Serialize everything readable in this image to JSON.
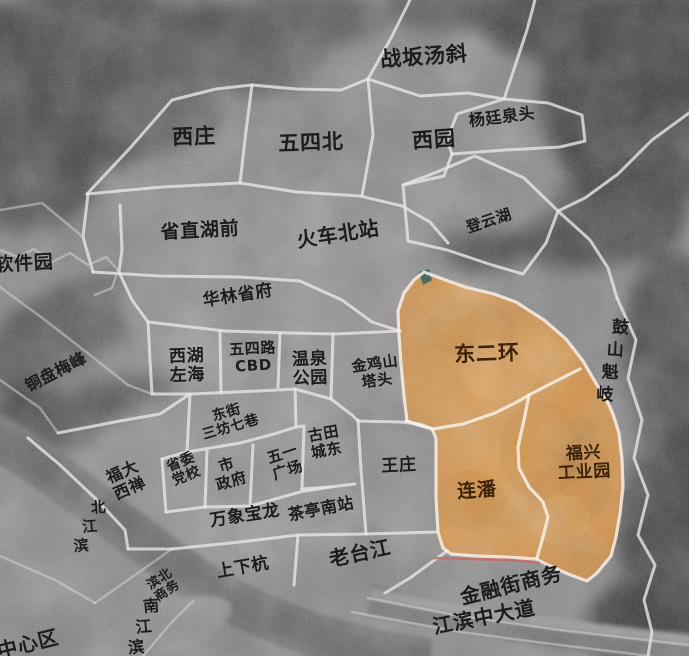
{
  "map": {
    "type": "satellite-district-map",
    "highlighted_regions": [
      "东二环",
      "连潘",
      "福兴工业园"
    ],
    "colors": {
      "highlight_fill": "#d68e3c",
      "boundary_line": "#e6e6e6",
      "label_text": "#1c1c1c",
      "highlight_label_text": "#3a2306",
      "red_road": "#cc6666"
    },
    "labels": [
      {
        "name": "zhanban-tangxie",
        "lines": [
          "战坂汤斜"
        ],
        "x": 424,
        "y": 57,
        "rot": -4,
        "size": 21
      },
      {
        "name": "yangting-quantou",
        "lines": [
          "杨廷泉头"
        ],
        "x": 502,
        "y": 117,
        "rot": -7,
        "size": 16
      },
      {
        "name": "xizhuang",
        "lines": [
          "西庄"
        ],
        "x": 194,
        "y": 137,
        "rot": -2,
        "size": 21
      },
      {
        "name": "wusibei",
        "lines": [
          "五四北"
        ],
        "x": 311,
        "y": 143,
        "rot": -2,
        "size": 21
      },
      {
        "name": "xiyuan",
        "lines": [
          "西园"
        ],
        "x": 434,
        "y": 140,
        "rot": -4,
        "size": 21
      },
      {
        "name": "dengyunhu",
        "lines": [
          "登云湖"
        ],
        "x": 489,
        "y": 221,
        "rot": -18,
        "size": 15
      },
      {
        "name": "shengzhi-huqian",
        "lines": [
          "省直湖前"
        ],
        "x": 200,
        "y": 231,
        "rot": -3,
        "size": 19
      },
      {
        "name": "huoche-beizhan",
        "lines": [
          "火车北站"
        ],
        "x": 338,
        "y": 234,
        "rot": -9,
        "size": 20
      },
      {
        "name": "ruanjianyuan",
        "lines": [
          "软件园"
        ],
        "x": 24,
        "y": 264,
        "rot": -3,
        "size": 19
      },
      {
        "name": "hualin-shengfu",
        "lines": [
          "华林省府"
        ],
        "x": 238,
        "y": 296,
        "rot": -9,
        "size": 17
      },
      {
        "name": "tongpan-meifeng",
        "lines": [
          "铜盘梅峰"
        ],
        "x": 56,
        "y": 372,
        "rot": -27,
        "size": 16
      },
      {
        "name": "xihu-zuohai",
        "lines": [
          "西湖",
          "左海"
        ],
        "x": 187,
        "y": 366,
        "rot": -2,
        "size": 17
      },
      {
        "name": "wusilu-cbd",
        "lines": [
          "五四路",
          "CBD"
        ],
        "x": 253,
        "y": 357,
        "rot": -3,
        "size": 15
      },
      {
        "name": "wenquan-gongyuan",
        "lines": [
          "温泉",
          "公园"
        ],
        "x": 310,
        "y": 369,
        "rot": -2,
        "size": 17
      },
      {
        "name": "jinjishan-tatou",
        "lines": [
          "金鸡山",
          "塔头"
        ],
        "x": 376,
        "y": 372,
        "rot": -8,
        "size": 15
      },
      {
        "name": "dong-er-huan",
        "lines": [
          "东二环"
        ],
        "x": 487,
        "y": 354,
        "rot": -2,
        "size": 21,
        "on_highlight": true
      },
      {
        "name": "gushan-kuiqi",
        "lines": [
          "鼓山魁岐"
        ],
        "x": 613,
        "y": 362,
        "rot": 13,
        "size": 17,
        "vertical": true,
        "char_rot": -10
      },
      {
        "name": "dongjie-sanfang-qixiang",
        "lines": [
          "东街",
          "三坊七巷"
        ],
        "x": 229,
        "y": 421,
        "rot": -16,
        "size": 14
      },
      {
        "name": "gutian-chengdong",
        "lines": [
          "古田",
          "城东"
        ],
        "x": 325,
        "y": 442,
        "rot": -10,
        "size": 15
      },
      {
        "name": "fuda-xichan",
        "lines": [
          "福大",
          "西禅"
        ],
        "x": 126,
        "y": 480,
        "rot": -24,
        "size": 16
      },
      {
        "name": "shengwei-dangxiao",
        "lines": [
          "省委",
          "党校"
        ],
        "x": 184,
        "y": 470,
        "rot": -22,
        "size": 14
      },
      {
        "name": "shi-zhengfu",
        "lines": [
          "市",
          "政府"
        ],
        "x": 229,
        "y": 473,
        "rot": -17,
        "size": 15
      },
      {
        "name": "wuyi-guangchang",
        "lines": [
          "五一",
          "广场"
        ],
        "x": 285,
        "y": 462,
        "rot": -18,
        "size": 15
      },
      {
        "name": "wangzhuang",
        "lines": [
          "王庄"
        ],
        "x": 399,
        "y": 466,
        "rot": -3,
        "size": 17
      },
      {
        "name": "lianpan",
        "lines": [
          "连潘"
        ],
        "x": 477,
        "y": 491,
        "rot": -4,
        "size": 19,
        "on_highlight": true
      },
      {
        "name": "fuxing-gongyeyuan",
        "lines": [
          "福兴",
          "工业园"
        ],
        "x": 584,
        "y": 463,
        "rot": -3,
        "size": 17,
        "on_highlight": true
      },
      {
        "name": "beijiangbin",
        "lines": [
          "北江滨"
        ],
        "x": 90,
        "y": 527,
        "rot": 24,
        "size": 15,
        "vertical": true,
        "char_rot": -28
      },
      {
        "name": "wanxiang-baolong",
        "lines": [
          "万象宝龙"
        ],
        "x": 245,
        "y": 516,
        "rot": -9,
        "size": 17
      },
      {
        "name": "chating-nanzhan",
        "lines": [
          "茶亭南站"
        ],
        "x": 321,
        "y": 509,
        "rot": -11,
        "size": 16
      },
      {
        "name": "binbei-shangwu",
        "lines": [
          "滨北",
          "商务"
        ],
        "x": 164,
        "y": 586,
        "rot": -33,
        "size": 13
      },
      {
        "name": "shangxiahang",
        "lines": [
          "上下杭"
        ],
        "x": 243,
        "y": 568,
        "rot": -10,
        "size": 17
      },
      {
        "name": "laotaijiang",
        "lines": [
          "老台江"
        ],
        "x": 360,
        "y": 553,
        "rot": -12,
        "size": 20
      },
      {
        "name": "jinrongjie-shangwu",
        "lines": [
          "金融街商务"
        ],
        "x": 511,
        "y": 585,
        "rot": -14,
        "size": 20
      },
      {
        "name": "jiangbin-zhongdadao",
        "lines": [
          "江滨中大道"
        ],
        "x": 484,
        "y": 617,
        "rot": -11,
        "size": 20
      },
      {
        "name": "nanjiangbin",
        "lines": [
          "南江滨"
        ],
        "x": 144,
        "y": 627,
        "rot": 20,
        "size": 16,
        "vertical": true,
        "char_rot": -25
      },
      {
        "name": "zhongxinqu",
        "lines": [
          "中心区"
        ],
        "x": 28,
        "y": 644,
        "rot": -14,
        "size": 20
      }
    ]
  }
}
